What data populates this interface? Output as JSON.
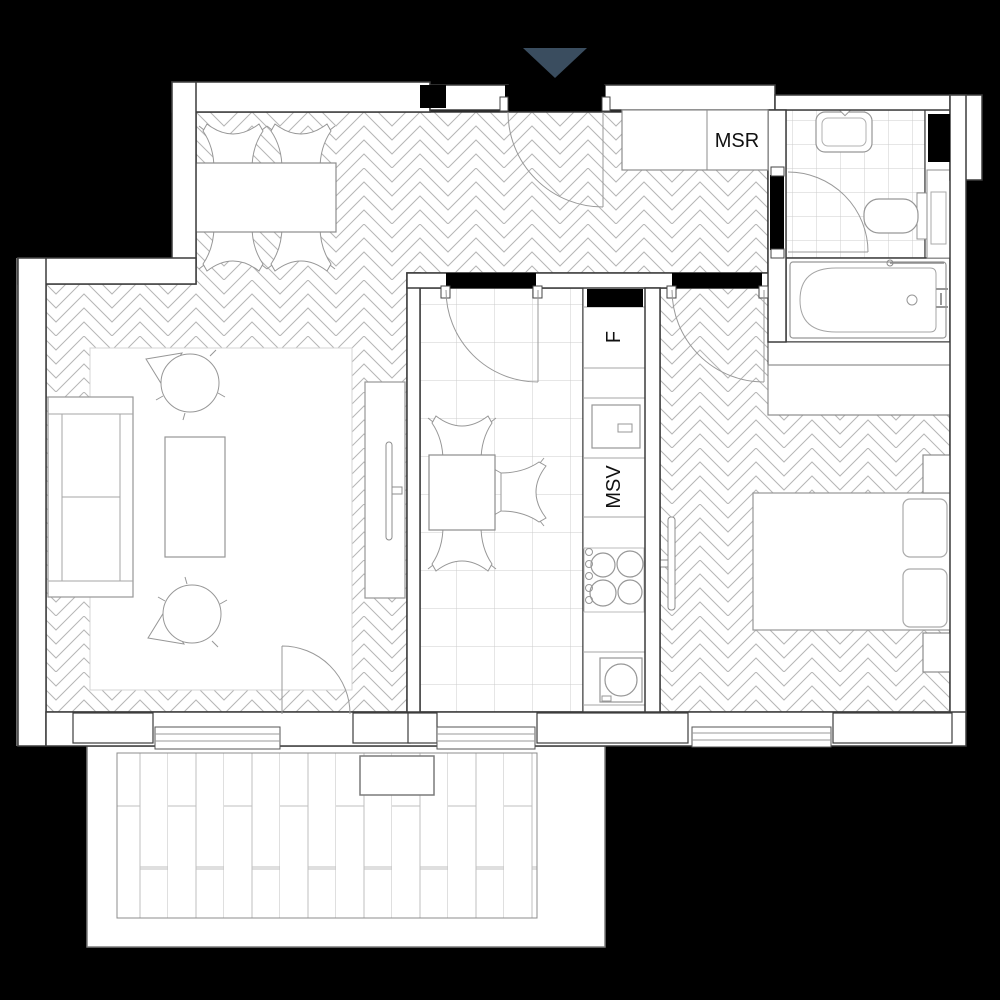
{
  "plan": {
    "entrance": {
      "marker": "down-arrow"
    },
    "labels": {
      "closet": "MSR",
      "fridge": "F",
      "ventilation": "MSV"
    },
    "colors": {
      "background": "#000000",
      "entrance_arrow": "#3a4d5f",
      "wall_fill": "#ffffff",
      "wall_outline": "#3c3c3c",
      "pattern_line": "#b6b6b6",
      "tile_line": "#cccccc",
      "furniture_line": "#979797",
      "label_text": "#111111"
    }
  }
}
